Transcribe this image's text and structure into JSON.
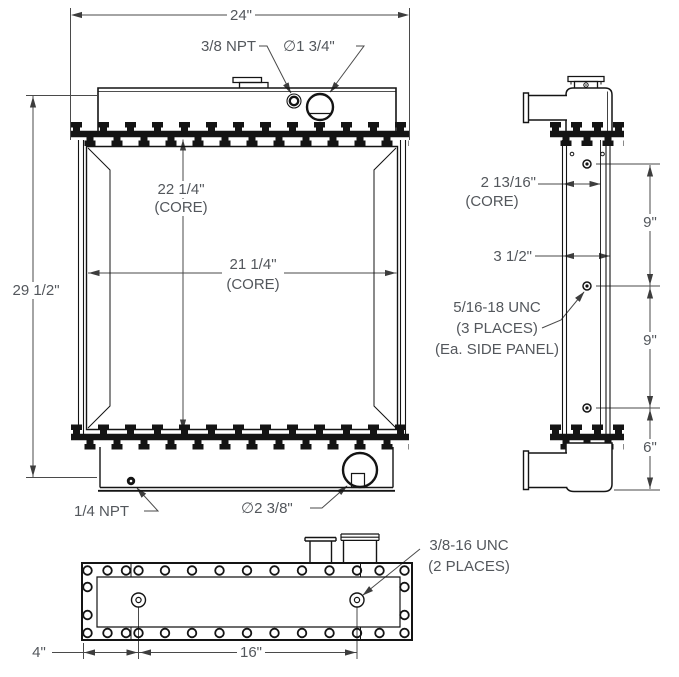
{
  "drawing": {
    "description": "Radiator engineering drawing with front, side and bottom orthographic views",
    "colors": {
      "background": "#ffffff",
      "object_lines": "#141414",
      "dimension_lines": "#4a4a4a",
      "text": "#53575c"
    }
  },
  "front_view": {
    "overall_width": "24\"",
    "overall_height": "29 1/2\"",
    "core_height": "22 1/4\"",
    "core_height_note": "(CORE)",
    "core_width": "21 1/4\"",
    "core_width_note": "(CORE)",
    "top_port": "3/8 NPT",
    "inlet_diameter": "∅1 3/4\"",
    "drain_port": "1/4 NPT",
    "outlet_diameter": "∅2 3/8\""
  },
  "side_view": {
    "core_depth": "2 13/16\"",
    "core_depth_note": "(CORE)",
    "overall_depth": "3 1/2\"",
    "panel_holes_line1": "5/16-18 UNC",
    "panel_holes_line2": "(3 PLACES)",
    "panel_holes_line3": "(Ea. SIDE PANEL)",
    "hole_spacing_upper": "9\"",
    "hole_spacing_lower": "9\"",
    "bottom_tank_height": "6\""
  },
  "bottom_view": {
    "mount_holes_line1": "3/8-16 UNC",
    "mount_holes_line2": "(2 PLACES)",
    "hole_edge_offset": "4\"",
    "hole_spacing": "16\""
  }
}
